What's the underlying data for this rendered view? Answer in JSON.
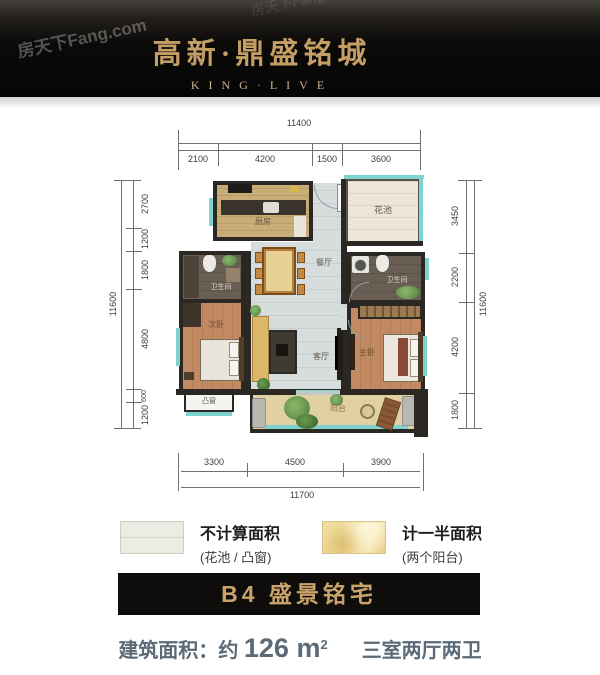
{
  "header": {
    "title": "高新·鼎盛铭城",
    "subtitle": "KING·LIVE",
    "watermark": "房天下Fang.com"
  },
  "plan": {
    "rooms": {
      "kitchen": "厨房",
      "flower_pool": "花池",
      "dining": "餐厅",
      "bath_left": "卫生间",
      "bath_right": "卫生间",
      "second_bedroom": "次卧",
      "living": "客厅",
      "master_bedroom": "主卧",
      "bay_window": "凸窗",
      "balcony": "阳台"
    },
    "dims": {
      "top_total": "11400",
      "top_segments": [
        "2100",
        "4200",
        "1500",
        "3600"
      ],
      "bottom_total": "11700",
      "bottom_segments": [
        "3300",
        "4500",
        "3900"
      ],
      "left_total": "11600",
      "left_segments": [
        "2700",
        "1200",
        "1800",
        "4800",
        "600",
        "1200"
      ],
      "right_total": "11600",
      "right_segments": [
        "3450",
        "2200",
        "4200",
        "1800"
      ]
    }
  },
  "legend": {
    "items": [
      {
        "title": "不计算面积",
        "subtitle": "(花池 / 凸窗)"
      },
      {
        "title": "计一半面积",
        "subtitle": "(两个阳台)"
      }
    ]
  },
  "banner": {
    "title": "B4 盛景铭宅"
  },
  "footer": {
    "area_label": "建筑面积：",
    "approx": "约 ",
    "value": "126",
    "unit": " m",
    "sup": "2",
    "layout_text": "三室两厅两卫"
  },
  "colors": {
    "gold": "#c9a36b",
    "teal_window": "#7fd3cf",
    "wall": "#2b2722",
    "footer_text": "#5b6a76",
    "banner_bg": "#0e0d0b"
  }
}
